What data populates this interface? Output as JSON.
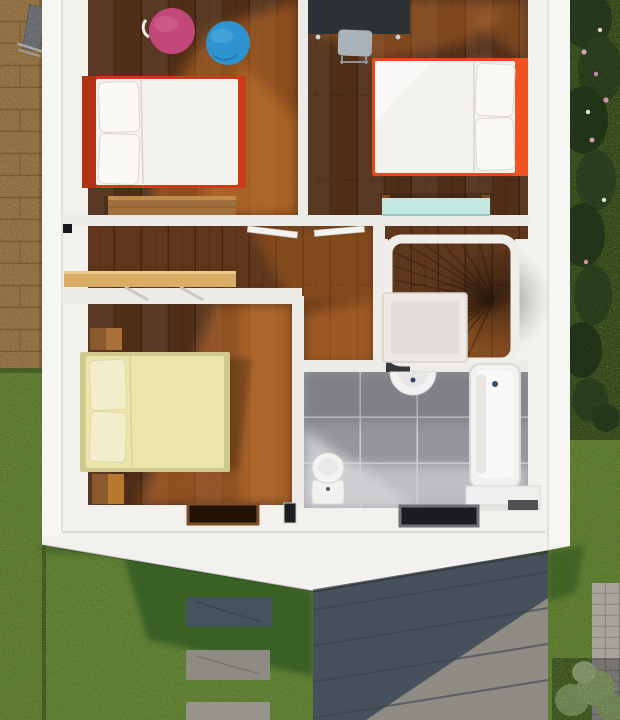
{
  "scene": {
    "description": "Photorealistic top-down 3D render of the upper floor plan of a house",
    "view": "top-down",
    "floor": "upper floor"
  },
  "rooms": [
    {
      "id": "bedroom-left",
      "name": "Bedroom (kids)",
      "furniture": [
        "double bed with red frame and white bedding",
        "pink pouf",
        "blue pouf",
        "wooden dresser"
      ]
    },
    {
      "id": "bedroom-right",
      "name": "Bedroom",
      "furniture": [
        "double bed with orange frame and white bedding",
        "dark charcoal desk",
        "grey desk chair",
        "teal low table"
      ]
    },
    {
      "id": "hallway",
      "name": "Hallway / landing",
      "furniture": [
        "wall-mounted tan shelf"
      ]
    },
    {
      "id": "bedroom-master",
      "name": "Master bedroom",
      "furniture": [
        "double bed with cream duvet",
        "wooden nightstand (top)",
        "wooden nightstand (bottom)"
      ]
    },
    {
      "id": "bathroom",
      "name": "Bathroom",
      "furniture": [
        "toilet",
        "semicircular wall sink",
        "bathtub",
        "white step bench"
      ]
    },
    {
      "id": "staircase",
      "name": "Winder staircase",
      "furniture": [
        "wooden fan treads",
        "white railing"
      ]
    }
  ],
  "exterior": {
    "left": "wooden deck with folded grey lounger, lawn below",
    "right": "lawn with dark hedge and pink/white flowering shrubs",
    "bottom": "grey standing-seam roof of lower level, lawn with cast shadow, stepping-stone path, cobblestone path, light green shrub",
    "features": [
      "dark roof window on ledge below master bedroom",
      "dark roof window on ledge below bathroom"
    ]
  },
  "colors": {
    "slab": "#f3f1ee",
    "slab_rim": "#f7f6f3",
    "wall": "#edebe6",
    "wood_dark": "#512e18",
    "wood_mid": "#5f371d",
    "deck": "#c79a5c",
    "grass": "#80a845",
    "grass_shadow": "#355c22",
    "roof_shadow": "#47515b",
    "roof_lit": "#8f8b85",
    "tile": "#94969c",
    "tile_light": "#d2d3d5",
    "mattress": "#f4f2ee",
    "bed1_frame": "#c93b1a",
    "bed2_frame": "#e24a1d",
    "bed3_frame": "#cfc98c",
    "bed3_duvet": "#ebe5ac",
    "pouf_pink": "#c24879",
    "pouf_blue": "#2e94cf",
    "desk": "#2c3136",
    "chair": "#a9b2b9",
    "table_teal": "#c3e8e2",
    "shelf": "#d9ad66",
    "dresser": "#a0703c",
    "nightstand": "#8a5a2e",
    "rail": "#f0eeea",
    "stone_dark": "#46525c",
    "stone_light": "#8e8b85",
    "cobble": "#a7a49c",
    "bush_dark": "#3a5a2c",
    "bush_light": "#a3bf7e",
    "hatch_dark": "#221306",
    "hatch_dark2": "#1e1c22",
    "fixture_white": "#f2f1ef"
  }
}
